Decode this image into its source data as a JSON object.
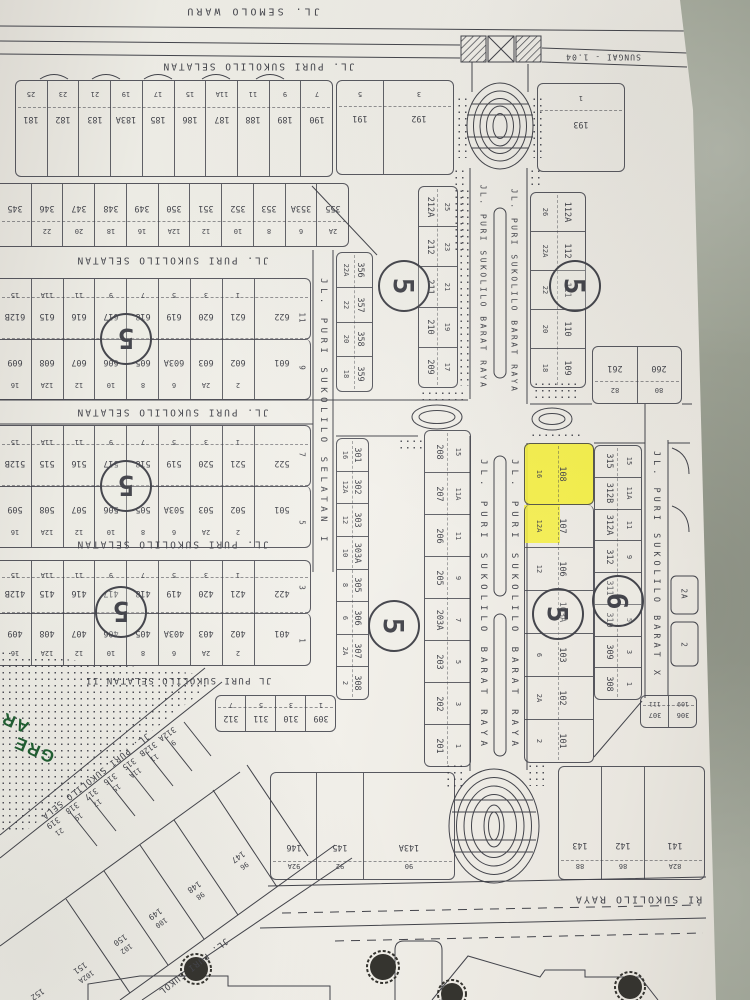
{
  "meta": {
    "colors": {
      "bg": "#a6aa9c",
      "paper": "#edeae2",
      "ink": "#43444b",
      "highlight": "#f4ee3c",
      "green": "#1f5e31"
    }
  },
  "labels": {
    "semolo": "JL. SEMOLO WARU",
    "sungai": "SUNGAI - 1.04",
    "selatan": "JL. PURI SUKOLILO SELATAN",
    "selatan_i": "JL. PURI SUKOLILO SELATAN I",
    "selatan_ii": "JL PURI SUKOLILO SELATAN II",
    "barat_raya": "JL. PURI SUKOLILO BARAT RAYA",
    "barat_x": "JL. PURI SUKOLILO BARAT X",
    "raya": "RI SUKOLILO RAYA",
    "sela_diag": "JL. PURI SUKOLILO SELA",
    "sukol_diag": "JL. PURI SUKOL",
    "green_1": "GRE",
    "green_2": "AR"
  },
  "circles": {
    "b600": "5",
    "b500": "5",
    "b400": "5",
    "c212": "5",
    "c201": "5",
    "c112": "5",
    "c108": "5",
    "c315": "6"
  },
  "sides": {
    "b600_a": "11",
    "b600_b": "9",
    "b500_a": "7",
    "b500_b": "5",
    "b400_a": "3",
    "b400_b": "1",
    "x_a": "2A",
    "x_b": "2"
  },
  "blocks": {
    "row_a": [
      {
        "n": "25",
        "p": "181"
      },
      {
        "n": "23",
        "p": "182"
      },
      {
        "n": "21",
        "p": "183"
      },
      {
        "n": "19",
        "p": "183A"
      },
      {
        "n": "17",
        "p": "185"
      },
      {
        "n": "15",
        "p": "186"
      },
      {
        "n": "11A",
        "p": "187"
      },
      {
        "n": "11",
        "p": "188"
      },
      {
        "n": "9",
        "p": "189"
      },
      {
        "n": "7",
        "p": "190"
      }
    ],
    "row_a_east": [
      {
        "n": "5",
        "p": "191"
      },
      {
        "n": "3",
        "p": "192"
      }
    ],
    "plot_193": [
      {
        "n": "1",
        "p": "193"
      }
    ],
    "row_b": [
      {
        "n": "",
        "p": "345"
      },
      {
        "n": "22",
        "p": "346"
      },
      {
        "n": "20",
        "p": "347"
      },
      {
        "n": "18",
        "p": "348"
      },
      {
        "n": "16",
        "p": "349"
      },
      {
        "n": "12A",
        "p": "350"
      },
      {
        "n": "12",
        "p": "351"
      },
      {
        "n": "10",
        "p": "352"
      },
      {
        "n": "8",
        "p": "353"
      },
      {
        "n": "6",
        "p": "353A"
      },
      {
        "n": "2A",
        "p": "355"
      }
    ],
    "b600_top": [
      {
        "n": "15",
        "p": "612B"
      },
      {
        "n": "11A",
        "p": "615"
      },
      {
        "n": "11",
        "p": "616"
      },
      {
        "n": "9",
        "p": "617"
      },
      {
        "n": "7",
        "p": "618"
      },
      {
        "n": "5",
        "p": "619"
      },
      {
        "n": "3",
        "p": "620"
      },
      {
        "n": "1",
        "p": "621"
      },
      {
        "n": "",
        "p": "622"
      }
    ],
    "b600_bot": [
      {
        "n": "16",
        "p": "609"
      },
      {
        "n": "12A",
        "p": "608"
      },
      {
        "n": "12",
        "p": "607"
      },
      {
        "n": "10",
        "p": "606"
      },
      {
        "n": "8",
        "p": "605"
      },
      {
        "n": "6",
        "p": "603A"
      },
      {
        "n": "2A",
        "p": "603"
      },
      {
        "n": "2",
        "p": "602"
      },
      {
        "n": "",
        "p": "601"
      }
    ],
    "b500_top": [
      {
        "n": "15",
        "p": "512B"
      },
      {
        "n": "11A",
        "p": "515"
      },
      {
        "n": "11",
        "p": "516"
      },
      {
        "n": "9",
        "p": "517"
      },
      {
        "n": "7",
        "p": "518"
      },
      {
        "n": "5",
        "p": "519"
      },
      {
        "n": "3",
        "p": "520"
      },
      {
        "n": "1",
        "p": "521"
      },
      {
        "n": "",
        "p": "522"
      }
    ],
    "b500_bot": [
      {
        "n": "16",
        "p": "509"
      },
      {
        "n": "12A",
        "p": "508"
      },
      {
        "n": "12",
        "p": "507"
      },
      {
        "n": "10",
        "p": "506"
      },
      {
        "n": "8",
        "p": "505"
      },
      {
        "n": "6",
        "p": "503A"
      },
      {
        "n": "2A",
        "p": "503"
      },
      {
        "n": "2",
        "p": "502"
      },
      {
        "n": "",
        "p": "501"
      }
    ],
    "b400_top": [
      {
        "n": "15",
        "p": "412B"
      },
      {
        "n": "11A",
        "p": "415"
      },
      {
        "n": "11",
        "p": "416"
      },
      {
        "n": "9",
        "p": "417"
      },
      {
        "n": "7",
        "p": "418"
      },
      {
        "n": "5",
        "p": "419"
      },
      {
        "n": "3",
        "p": "420"
      },
      {
        "n": "1",
        "p": "421"
      },
      {
        "n": "",
        "p": "422"
      }
    ],
    "b400_bot": [
      {
        "n": "16",
        "p": "409"
      },
      {
        "n": "12A",
        "p": "408"
      },
      {
        "n": "12",
        "p": "407"
      },
      {
        "n": "10",
        "p": "406"
      },
      {
        "n": "8",
        "p": "405"
      },
      {
        "n": "6",
        "p": "403A"
      },
      {
        "n": "2A",
        "p": "403"
      },
      {
        "n": "2",
        "p": "402"
      },
      {
        "n": "",
        "p": "401"
      }
    ],
    "row_309": [
      {
        "n": "7",
        "p": "312"
      },
      {
        "n": "5",
        "p": "311"
      },
      {
        "n": "3",
        "p": "310"
      },
      {
        "n": "1",
        "p": "309"
      }
    ],
    "col_356": [
      {
        "n": "22A",
        "p": "356"
      },
      {
        "n": "22",
        "p": "357"
      },
      {
        "n": "20",
        "p": "358"
      },
      {
        "n": "18",
        "p": "359"
      }
    ],
    "col_212": [
      {
        "n": "25",
        "p": "212A"
      },
      {
        "n": "23",
        "p": "212"
      },
      {
        "n": "21",
        "p": "211"
      },
      {
        "n": "19",
        "p": "210"
      },
      {
        "n": "17",
        "p": "209"
      }
    ],
    "col_301": [
      {
        "n": "16",
        "p": "301"
      },
      {
        "n": "12A",
        "p": "302"
      },
      {
        "n": "12",
        "p": "303"
      },
      {
        "n": "10",
        "p": "303A"
      },
      {
        "n": "8",
        "p": "305"
      },
      {
        "n": "6",
        "p": "306"
      },
      {
        "n": "2A",
        "p": "307"
      },
      {
        "n": "2",
        "p": "308"
      }
    ],
    "col_201": [
      {
        "n": "15",
        "p": "208"
      },
      {
        "n": "11A",
        "p": "207"
      },
      {
        "n": "11",
        "p": "206"
      },
      {
        "n": "9",
        "p": "205"
      },
      {
        "n": "7",
        "p": "203A"
      },
      {
        "n": "5",
        "p": "203"
      },
      {
        "n": "3",
        "p": "202"
      },
      {
        "n": "1",
        "p": "201"
      }
    ],
    "col_112": [
      {
        "n": "26",
        "p": "112A"
      },
      {
        "n": "22A",
        "p": "112"
      },
      {
        "n": "22",
        "p": "111"
      },
      {
        "n": "20",
        "p": "110"
      },
      {
        "n": "18",
        "p": "109"
      }
    ],
    "block_261": [
      {
        "n": "82",
        "p": "261"
      },
      {
        "n": "80",
        "p": "260"
      }
    ],
    "plot_108": [
      {
        "n": "16",
        "p": "108"
      }
    ],
    "col_108_rest": [
      {
        "n": "12A",
        "p": "107"
      },
      {
        "n": "12",
        "p": "106"
      },
      {
        "n": "",
        "p": "103A"
      },
      {
        "n": "6",
        "p": "103"
      },
      {
        "n": "2A",
        "p": "102"
      },
      {
        "n": "2",
        "p": "101"
      }
    ],
    "col_315": [
      {
        "n": "15",
        "p": "315"
      },
      {
        "n": "11A",
        "p": "312B"
      },
      {
        "n": "11",
        "p": "312A"
      },
      {
        "n": "9",
        "p": "312"
      },
      {
        "n": "",
        "p": "311"
      },
      {
        "n": "5",
        "p": "310"
      },
      {
        "n": "3",
        "p": "309"
      },
      {
        "n": "1",
        "p": "308"
      }
    ],
    "pair_307": [
      {
        "n": "111",
        "p": "307"
      },
      {
        "n": "109",
        "p": "306"
      }
    ],
    "bottom_west": [
      {
        "n": "92A",
        "p": "146"
      },
      {
        "n": "92",
        "p": "145"
      },
      {
        "n": "90",
        "p": "143A"
      }
    ],
    "bottom_east": [
      {
        "n": "88",
        "p": "143"
      },
      {
        "n": "86",
        "p": "142"
      },
      {
        "n": "82A",
        "p": "141"
      }
    ],
    "diag1": [
      {
        "n": "9",
        "p": "312A"
      },
      {
        "n": "11",
        "p": "312B"
      },
      {
        "n": "11A",
        "p": "315"
      },
      {
        "n": "15",
        "p": "316"
      },
      {
        "n": "17",
        "p": "317"
      },
      {
        "n": "19",
        "p": "318"
      },
      {
        "n": "21",
        "p": "319"
      }
    ],
    "diag2": [
      {
        "n": "96",
        "p": "147"
      },
      {
        "n": "98",
        "p": "148"
      },
      {
        "n": "100",
        "p": "149"
      },
      {
        "n": "102",
        "p": "150"
      },
      {
        "n": "102A",
        "p": "151"
      },
      {
        "n": "",
        "p": "152"
      }
    ]
  }
}
